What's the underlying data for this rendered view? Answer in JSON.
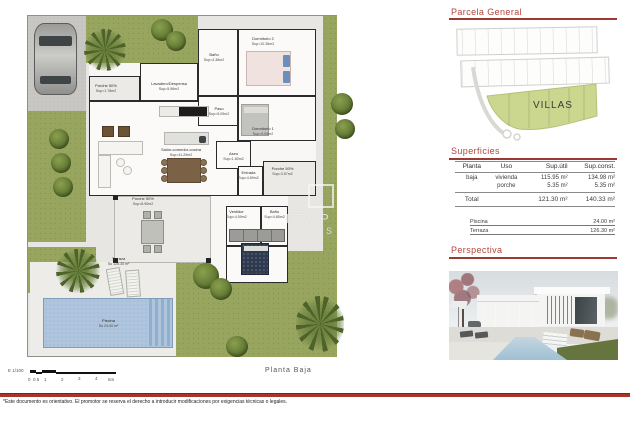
{
  "colors": {
    "accent_red": "#b0473d",
    "rule_red": "#9b3a33",
    "band_red": "#a8352c",
    "villas_green": "#cbd78f",
    "lawn_green": "#98a55e",
    "pool_blue": "#aec5dd"
  },
  "right_panel": {
    "parcela": {
      "title": "Parcela General",
      "villas_label": "VILLAS"
    },
    "superficies": {
      "title": "Superficies",
      "col_headers": [
        "Planta",
        "Uso",
        "Sup.útil",
        "Sup.const."
      ],
      "rows": [
        {
          "planta": "baja",
          "uso": "vivienda",
          "util": "115.95 m²",
          "konst": "134.98 m²"
        },
        {
          "planta": "",
          "uso": "porche",
          "util": "5.35 m²",
          "konst": "5.35 m²"
        }
      ],
      "total_label": "Total",
      "total_util": "121.30 m²",
      "total_const": "140.33 m²",
      "extras": [
        {
          "label": "Piscina",
          "value": "24.00 m²"
        },
        {
          "label": "Terraza",
          "value": "126.30 m²"
        }
      ]
    },
    "perspectiva": {
      "title": "Perspectiva"
    }
  },
  "plan": {
    "title": "Planta Baja",
    "watermark": {
      "line1": "PROP",
      "line2": "S"
    },
    "rooms": [
      {
        "name": "Dormitorio 2",
        "sup": "Sup=10.36m2"
      },
      {
        "name": "Baño",
        "sup": "Sup=4.38m2"
      },
      {
        "name": "Lavadero/Despensa",
        "sup": "Sup=5.96m2"
      },
      {
        "name": "Porche 50%",
        "sup": "Sup=1.78m2"
      },
      {
        "name": "Paso",
        "sup": "Sup=5.09m2"
      },
      {
        "name": "Dormitorio 1",
        "sup": "Sup=9.09m2"
      },
      {
        "name": "Salón-comedor-cocina",
        "sup": "Sup=41.29m2"
      },
      {
        "name": "Aseo",
        "sup": "Sup=1.80m2"
      },
      {
        "name": "Entrada",
        "sup": "Sup=4.69m2"
      },
      {
        "name": "Porche 50%",
        "sup": "Sup=3.57m2"
      },
      {
        "name": "Porche 50%",
        "sup": "Sup=8.90m2"
      },
      {
        "name": "Vestidor",
        "sup": "Sup=4.59m2"
      },
      {
        "name": "Baño",
        "sup": "Sup=4.85m2"
      },
      {
        "name": "Dormitorio 3",
        "sup": "Sup=13.68m2"
      },
      {
        "name": "Terraza",
        "sup": "Su 126.30 m²"
      },
      {
        "name": "Piscina",
        "sup": "Su 24.00 m²"
      }
    ]
  },
  "scalebar": {
    "scale": "E 1/100",
    "ticks": [
      "0",
      "0.5",
      "1",
      "2",
      "3",
      "4",
      "5m"
    ]
  },
  "footer": {
    "disclaimer": "*Este documento es orientativo. El promotor se reserva el derecho a introducir modificaciones por exigencias técnicas o legales."
  }
}
